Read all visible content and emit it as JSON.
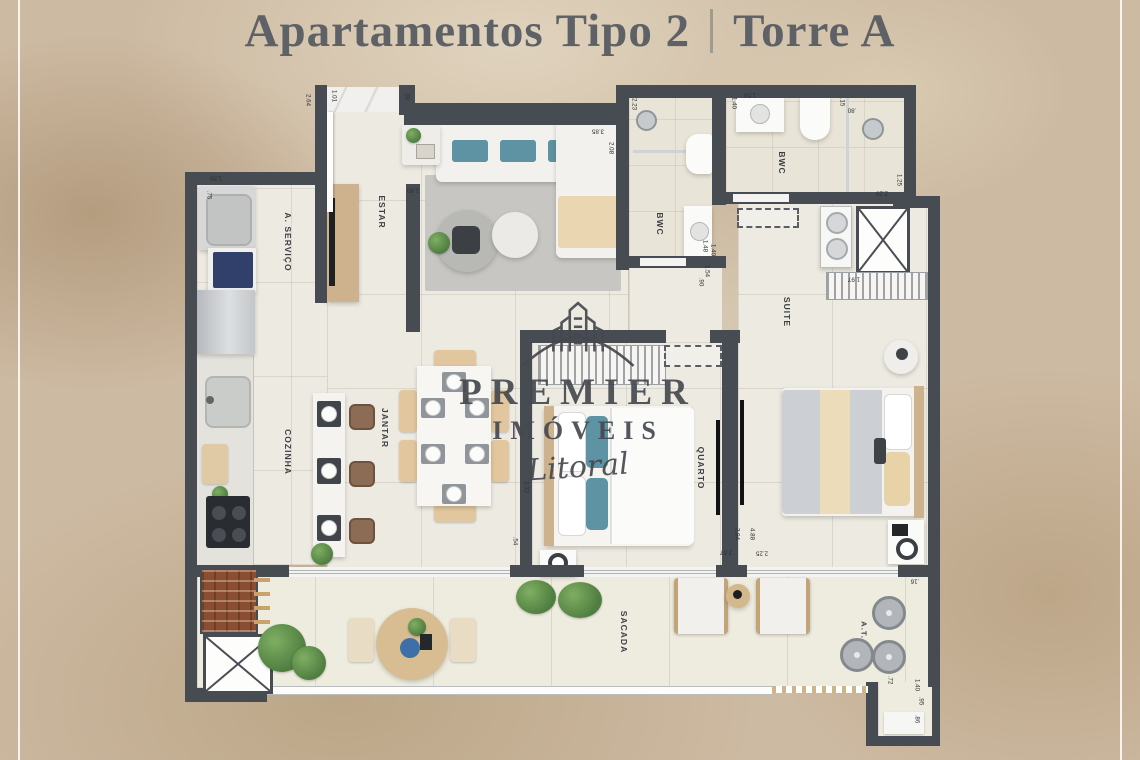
{
  "title": {
    "left": "Apartamentos Tipo 2",
    "right": "Torre A"
  },
  "brand": {
    "name": "PREMIER",
    "type": "IMÓVEIS",
    "sub": "Litoral"
  },
  "rooms": {
    "estar": "ESTAR",
    "servico": "A. SERVIÇO",
    "cozinha": "COZINHA",
    "jantar": "JANTAR",
    "bwc_social": "BWC",
    "bwc_suite": "BWC",
    "quarto": "QUARTO",
    "suite": "SUITE",
    "sacada": "SACADA",
    "area_tecnica": "A.T."
  },
  "dims": [
    "2.64",
    "1.01",
    ".30",
    "1.50",
    ".75",
    "1.60",
    "2.23",
    "3.85",
    "2.08",
    "1.40",
    "1.50",
    ".15",
    ".80",
    "1.25",
    "2.20",
    "1.97",
    "1.48",
    "1.40",
    "1.54",
    ".90",
    "3.32",
    ".54",
    "2.94",
    "2.57",
    "4.88",
    "2.25",
    ".16",
    ".72",
    "1.40",
    ".95",
    ".86"
  ],
  "colors": {
    "wall": "#474c53",
    "sand": "#cdbaa2",
    "teal": "#5d93a2",
    "floor": "#edeae2"
  }
}
